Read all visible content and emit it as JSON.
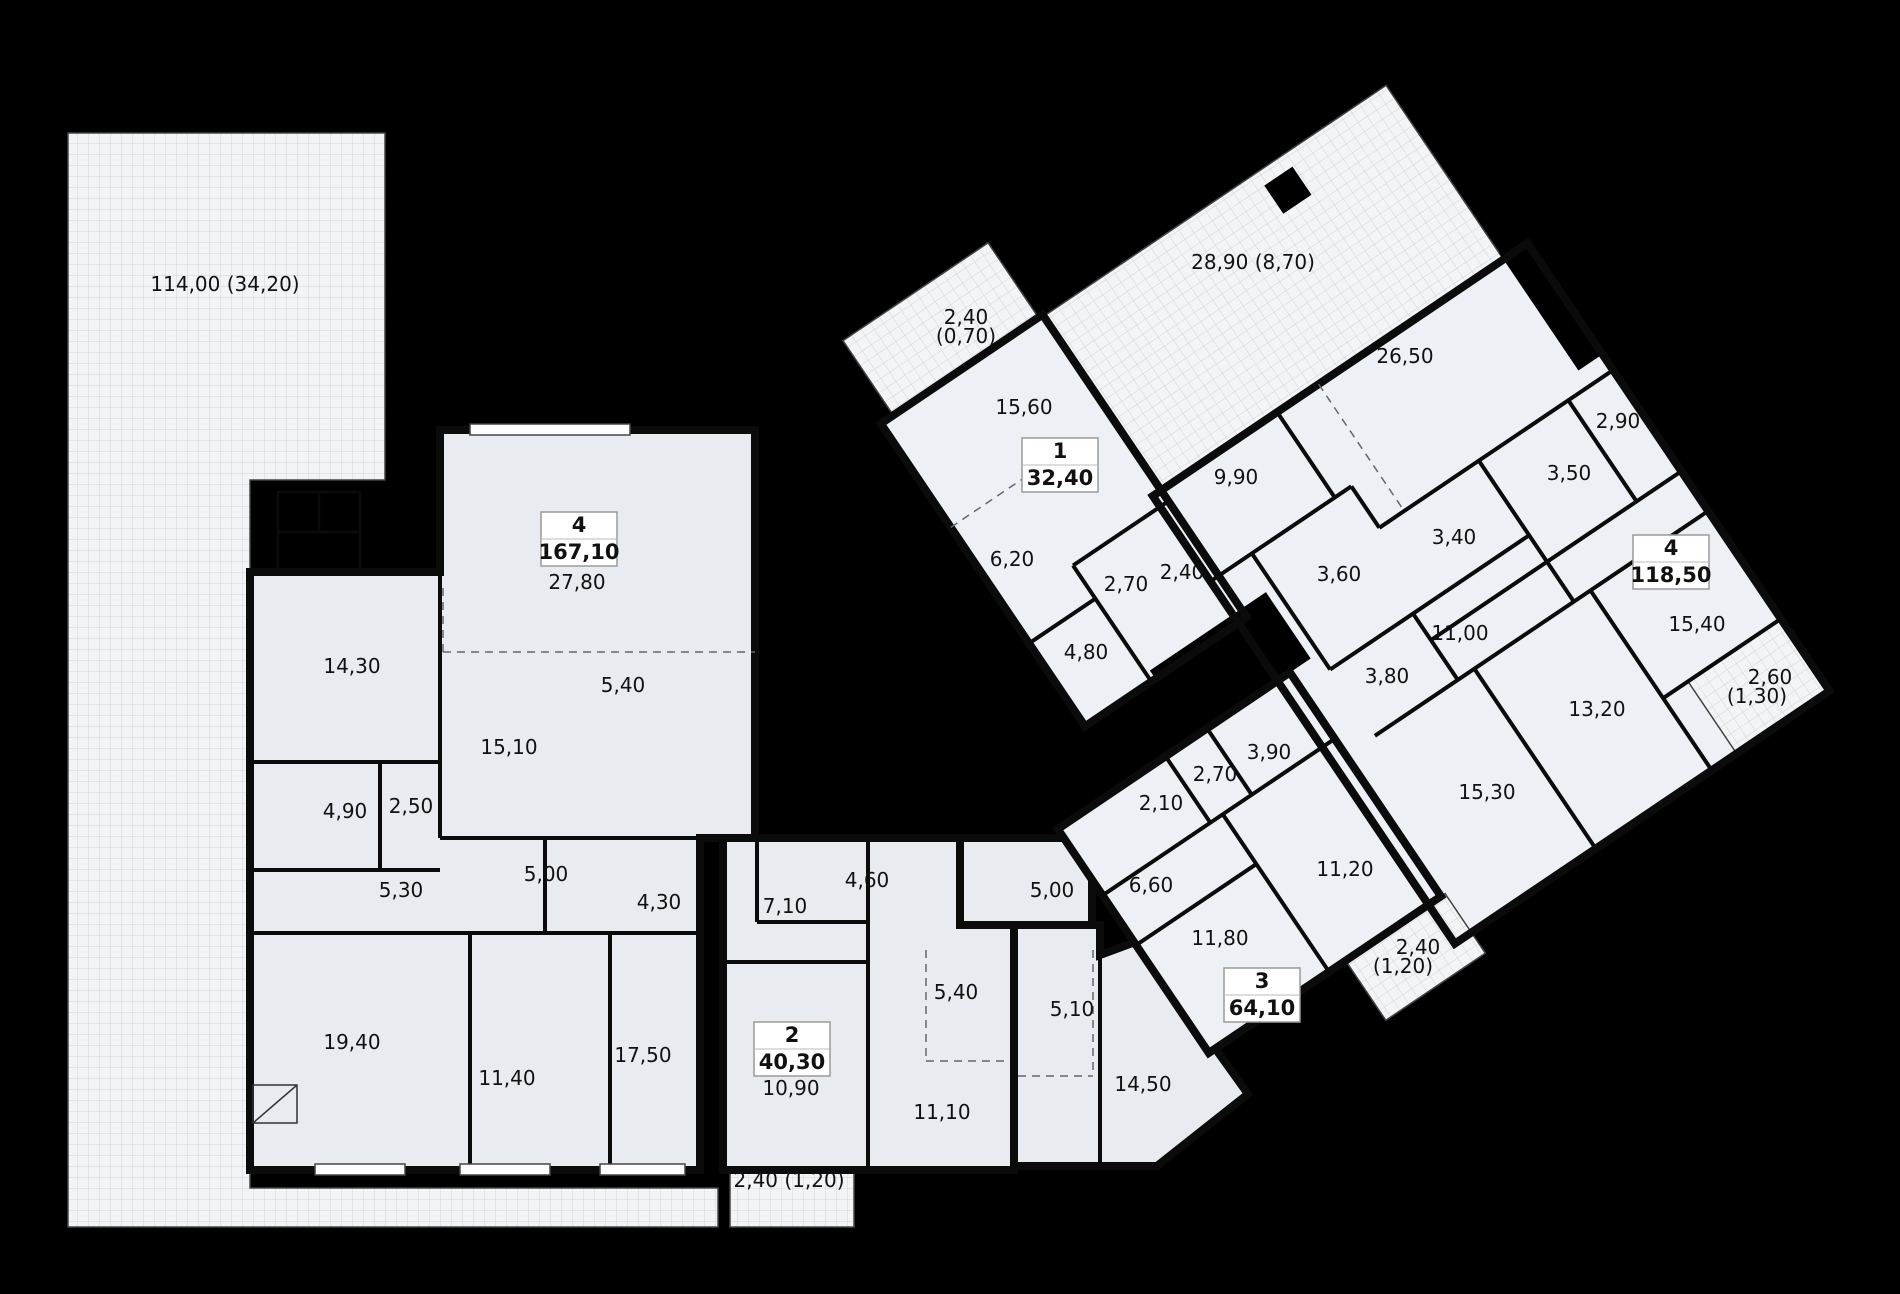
{
  "plan": {
    "title": "floor-plan",
    "colors": {
      "background": "#000000",
      "wall": "#0b0b0b",
      "floor_left_wing": "#e8ebef",
      "floor_right_wing": "#edf1f5",
      "terrace_fill": "#f3f4f6",
      "terrace_grid": "#d0d4da",
      "badge_border": "#9a9a9a",
      "label_color": "#111111"
    },
    "apartments": [
      {
        "id": "apt-1",
        "number": "1",
        "total_area": "32,40",
        "badge": {
          "x": 1060,
          "y": 465
        }
      },
      {
        "id": "apt-2",
        "number": "2",
        "total_area": "40,30",
        "badge": {
          "x": 792,
          "y": 1049
        }
      },
      {
        "id": "apt-3",
        "number": "3",
        "total_area": "64,10",
        "badge": {
          "x": 1262,
          "y": 995
        }
      },
      {
        "id": "apt-4-left",
        "number": "4",
        "total_area": "167,10",
        "badge": {
          "x": 579,
          "y": 539
        }
      },
      {
        "id": "apt-4-right",
        "number": "4",
        "total_area": "118,50",
        "badge": {
          "x": 1671,
          "y": 562
        }
      }
    ],
    "area_labels": [
      {
        "text": "114,00 (34,20)",
        "x": 225,
        "y": 291
      },
      {
        "text": "27,80",
        "x": 577,
        "y": 589
      },
      {
        "text": "5,40",
        "x": 623,
        "y": 692
      },
      {
        "text": "14,30",
        "x": 352,
        "y": 673
      },
      {
        "text": "15,10",
        "x": 509,
        "y": 754
      },
      {
        "text": "4,90",
        "x": 345,
        "y": 818
      },
      {
        "text": "2,50",
        "x": 411,
        "y": 813
      },
      {
        "text": "5,30",
        "x": 401,
        "y": 897
      },
      {
        "text": "5,00",
        "x": 546,
        "y": 881
      },
      {
        "text": "4,30",
        "x": 659,
        "y": 909
      },
      {
        "text": "19,40",
        "x": 352,
        "y": 1049
      },
      {
        "text": "11,40",
        "x": 507,
        "y": 1085
      },
      {
        "text": "17,50",
        "x": 643,
        "y": 1062
      },
      {
        "text": "2,40 (1,20)",
        "x": 789,
        "y": 1187
      },
      {
        "text": "7,10",
        "x": 785,
        "y": 913
      },
      {
        "text": "4,60",
        "x": 867,
        "y": 887
      },
      {
        "text": "10,90",
        "x": 791,
        "y": 1095
      },
      {
        "text": "5,40",
        "x": 956,
        "y": 999
      },
      {
        "text": "11,10",
        "x": 942,
        "y": 1119
      },
      {
        "text": "5,00",
        "x": 1052,
        "y": 897
      },
      {
        "text": "5,10",
        "x": 1072,
        "y": 1016
      },
      {
        "text": "14,50",
        "x": 1143,
        "y": 1091
      },
      {
        "text": "6,60",
        "x": 1151,
        "y": 892
      },
      {
        "text": "2,10",
        "x": 1161,
        "y": 810
      },
      {
        "text": "2,70",
        "x": 1215,
        "y": 781
      },
      {
        "text": "3,90",
        "x": 1269,
        "y": 759
      },
      {
        "text": "11,80",
        "x": 1220,
        "y": 945
      },
      {
        "text": "11,20",
        "x": 1345,
        "y": 876
      },
      {
        "text": "2,40",
        "x": 1418,
        "y": 954,
        "size": 19
      },
      {
        "text": "(1,20)",
        "x": 1403,
        "y": 973,
        "size": 19
      },
      {
        "text": "2,40",
        "x": 966,
        "y": 324,
        "size": 19
      },
      {
        "text": "(0,70)",
        "x": 966,
        "y": 343,
        "size": 19
      },
      {
        "text": "15,60",
        "x": 1024,
        "y": 414
      },
      {
        "text": "6,20",
        "x": 1012,
        "y": 566
      },
      {
        "text": "2,70",
        "x": 1126,
        "y": 591
      },
      {
        "text": "2,40",
        "x": 1182,
        "y": 579
      },
      {
        "text": "4,80",
        "x": 1086,
        "y": 659
      },
      {
        "text": "28,90 (8,70)",
        "x": 1253,
        "y": 269
      },
      {
        "text": "26,50",
        "x": 1405,
        "y": 363
      },
      {
        "text": "9,90",
        "x": 1236,
        "y": 484
      },
      {
        "text": "3,60",
        "x": 1339,
        "y": 581
      },
      {
        "text": "3,40",
        "x": 1454,
        "y": 544
      },
      {
        "text": "3,50",
        "x": 1569,
        "y": 480
      },
      {
        "text": "2,90",
        "x": 1618,
        "y": 428
      },
      {
        "text": "15,40",
        "x": 1697,
        "y": 631
      },
      {
        "text": "2,60",
        "x": 1770,
        "y": 684,
        "size": 19
      },
      {
        "text": "(1,30)",
        "x": 1757,
        "y": 703,
        "size": 19
      },
      {
        "text": "11,00",
        "x": 1460,
        "y": 640
      },
      {
        "text": "3,80",
        "x": 1387,
        "y": 683
      },
      {
        "text": "13,20",
        "x": 1597,
        "y": 716
      },
      {
        "text": "15,30",
        "x": 1487,
        "y": 799
      }
    ]
  }
}
